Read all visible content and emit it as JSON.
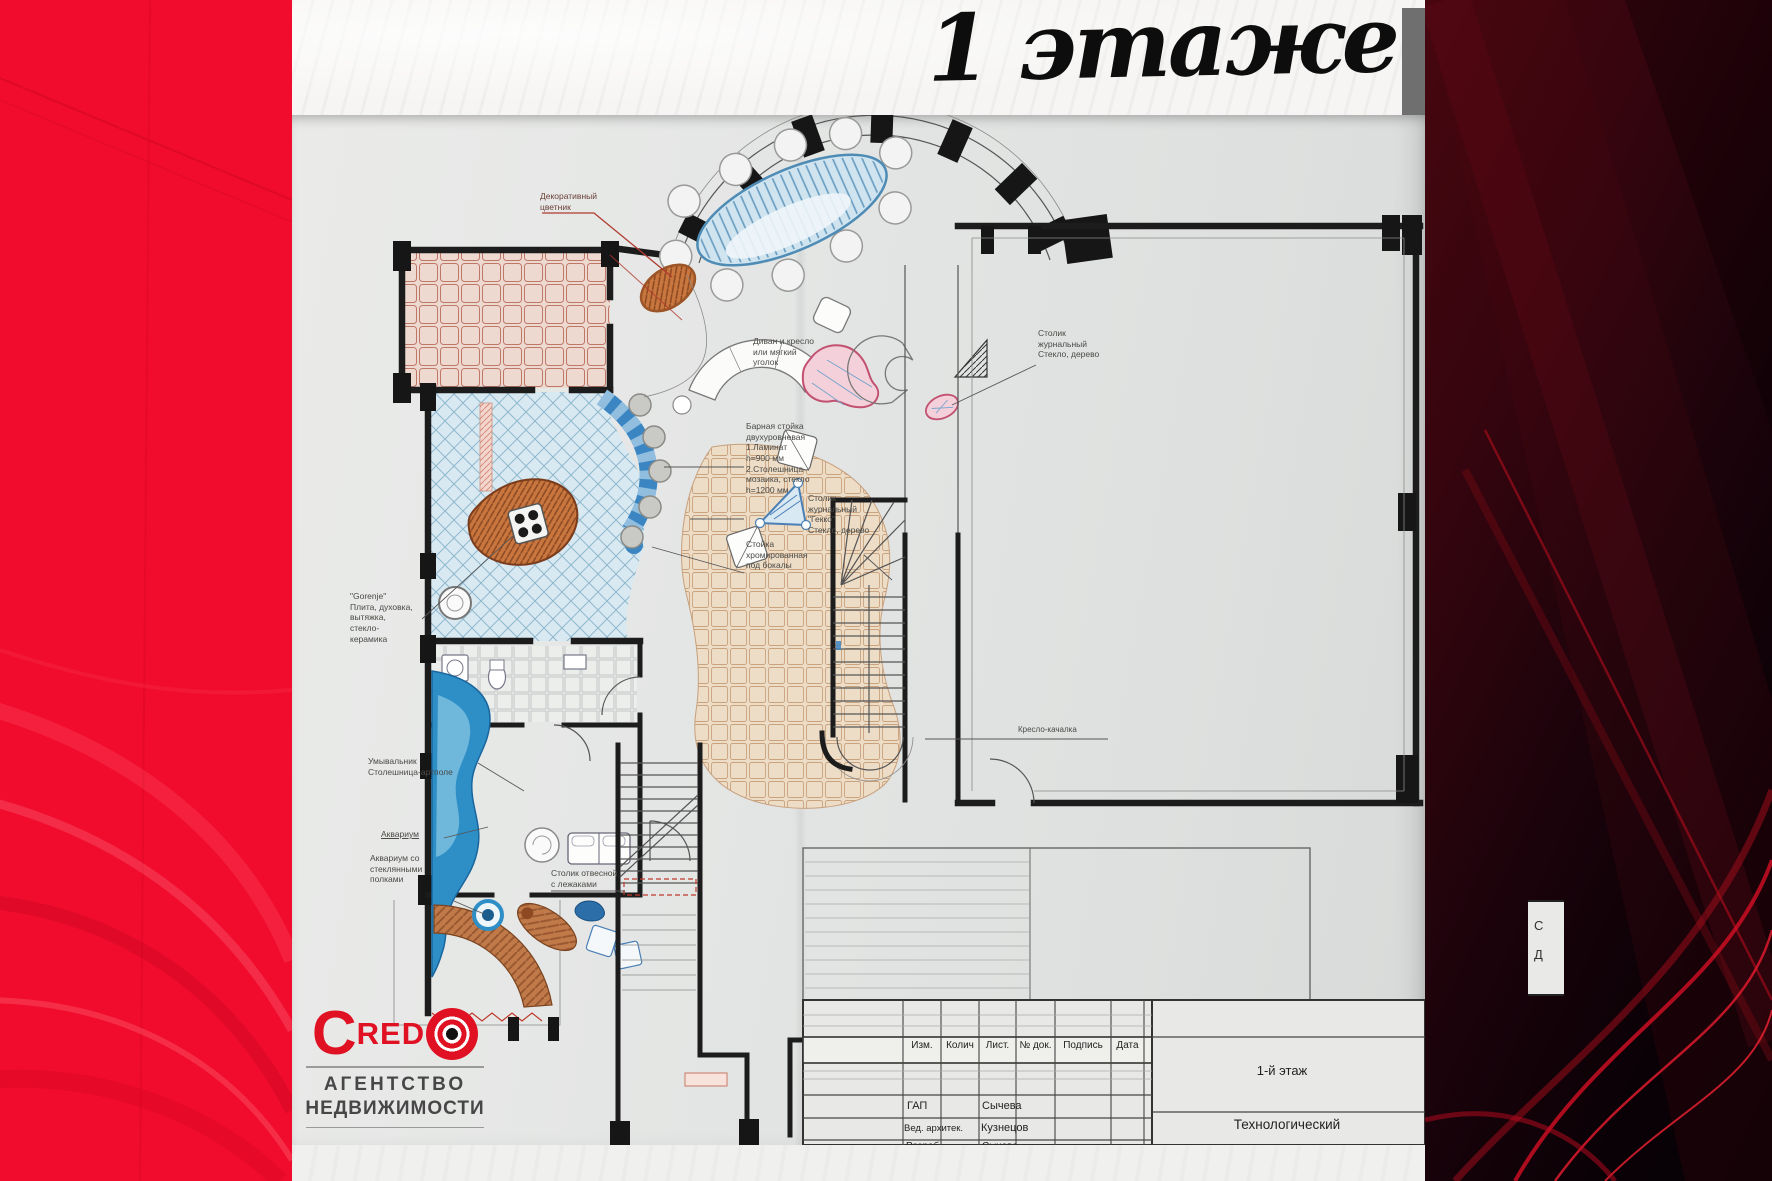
{
  "slide": {
    "floor_title": "1 этаже"
  },
  "logo": {
    "c_letter": "C",
    "red_letters": "RED",
    "agency_line1": "АГЕНТСТВО",
    "agency_line2": "НЕДВИЖИМОСТИ",
    "brand_color": "#e01122"
  },
  "plan": {
    "labels": {
      "flower": "Декоративный\nцветник",
      "sofa": "Диван и кресло\nили мягкий\nуголок",
      "bar": "Барная стойка\nдвухуровневая\n1.Ламинат\nh=900 мм\n2.Столешница-\nмозаика, стекло\nh=1200 мм",
      "table_gekko": "Столик\nжурнальный\n\"Гекко\"\nСтекло, дерево",
      "glass_stand": "Стойка\nхромированная\nпод бокалы",
      "table_right": "Столик\nжурнальный\nСтекло, дерево",
      "stove": "\"Gorenje\"\nПлита, духовка,\nвытяжка,\nстекло-\nкерамика",
      "washbasin": "Умывальник\nСтолешница-артполе",
      "aquarium": "Аквариум",
      "aquarium_shelves": "Аквариум со\nстеклянными\nполками",
      "wall_table": "Столик отвесной\nс лежаками",
      "chair": "Кресло-качалка"
    },
    "title_block": {
      "headers": [
        "Изм.",
        "Колич",
        "Лист.",
        "№ док.",
        "Подпись",
        "Дата"
      ],
      "rows": [
        [
          "ГАП",
          "Сычева"
        ],
        [
          "Вед. архитек.",
          "Кузнецов"
        ],
        [
          "Разраб.",
          "Сычева"
        ]
      ],
      "floor": "1-й этаж",
      "doc_type": "Технологический"
    },
    "edge_fragments": {
      "top": "С",
      "bottom": "Д"
    }
  }
}
